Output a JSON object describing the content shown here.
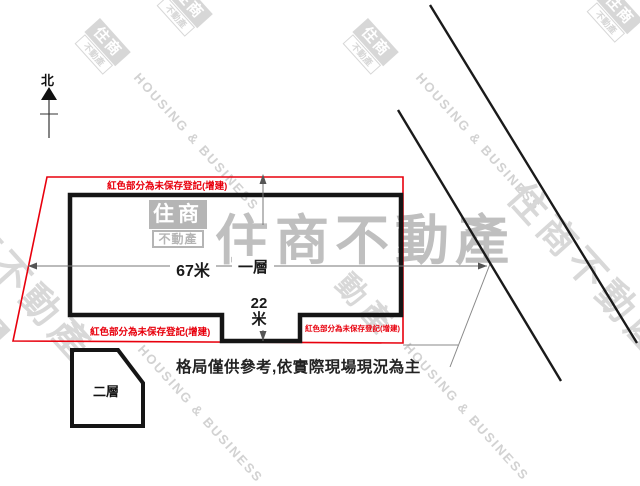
{
  "compass": {
    "north_label": "北"
  },
  "plan": {
    "red_note_top": "紅色部分為未保存登記(增建)",
    "red_note_bottom_left": "紅色部分為未保存登記(增建)",
    "red_note_bottom_right": "紅色部分為未保存登記(增建)",
    "floor1_label": "一層",
    "floor2_label": "二層",
    "width_dim_label": "67米",
    "depth_dim_value": "22",
    "depth_dim_unit": "米"
  },
  "footer_note": "格局僅供參考,依實際現場現況為主",
  "watermark": {
    "brand_cjk": "住商不動產",
    "brand_cjk_fragment": "動產",
    "brand_en": "HOUSING & BUSINESS",
    "logo_top": "住商",
    "logo_bottom": "不動產"
  },
  "colors": {
    "annotation_red": "#e8000d",
    "outline_black": "#151515",
    "watermark_gray": "#c9c9c9"
  }
}
